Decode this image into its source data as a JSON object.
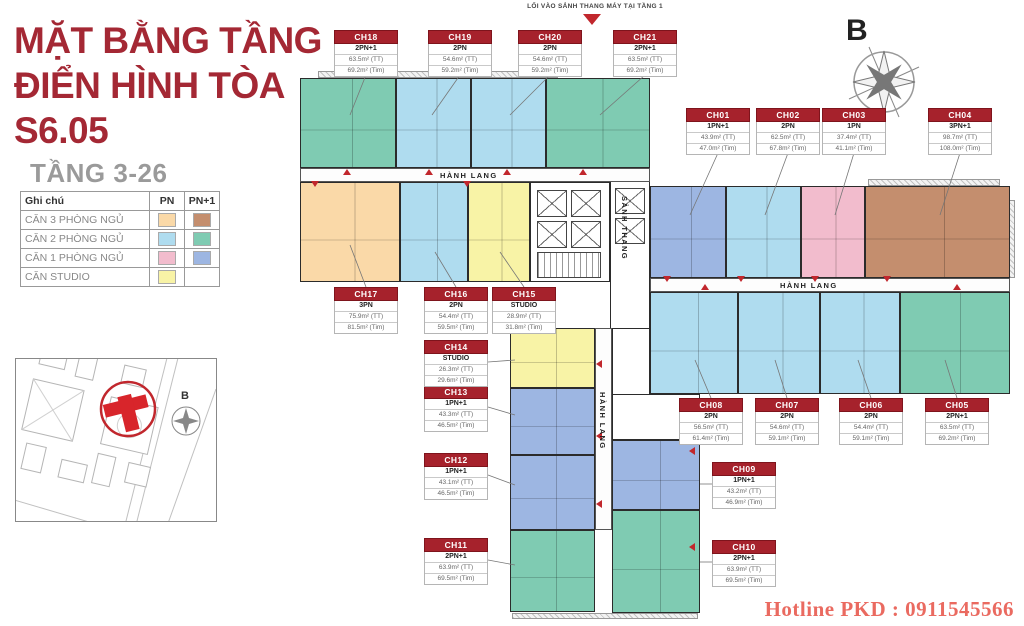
{
  "header": {
    "title_line1": "MẶT BẰNG TẦNG",
    "title_line2": "ĐIỂN HÌNH TÒA",
    "title_line3": "S6.05",
    "subtitle": "TẦNG 3-26"
  },
  "entrance_note": "LỐI VÀO SẢNH THANG MÁY TẠI TẦNG 1",
  "compass": {
    "label": "B"
  },
  "inset": {
    "compass_label": "B"
  },
  "hotline": "Hotline PKD : 0911545566",
  "corridors": {
    "hallway": "HÀNH LANG",
    "lobby": "SẢNH THANG"
  },
  "colors": {
    "accent": "#A42834",
    "marker_red": "#C1272D",
    "hotline_red": "#EA6A60",
    "cat": {
      "pn3": "#FAD9A8",
      "pn3p": "#C48E6E",
      "pn2": "#AFDCEF",
      "pn2p": "#7FCBB2",
      "pn1": "#F2BCCD",
      "pn1p": "#9DB6E2",
      "studio": "#F8F3A6"
    }
  },
  "legend": {
    "col_label": "Ghi chú",
    "col_pn": "PN",
    "col_pn1": "PN+1",
    "rows": [
      {
        "label": "CĂN 3 PHÒNG NGỦ",
        "pn": "pn3",
        "pn1": "pn3p"
      },
      {
        "label": "CĂN 2 PHÒNG NGỦ",
        "pn": "pn2",
        "pn1": "pn2p"
      },
      {
        "label": "CĂN 1 PHÒNG NGỦ",
        "pn": "pn1",
        "pn1": "pn1p"
      },
      {
        "label": "CĂN STUDIO",
        "pn": "studio",
        "pn1": null
      }
    ]
  },
  "units": [
    {
      "code": "CH01",
      "type": "1PN+1",
      "area_tt": "43.9m² (TT)",
      "area_tim": "47.0m² (Tim)",
      "cat": "pn1p"
    },
    {
      "code": "CH02",
      "type": "2PN",
      "area_tt": "62.5m² (TT)",
      "area_tim": "67.8m² (Tim)",
      "cat": "pn2"
    },
    {
      "code": "CH03",
      "type": "1PN",
      "area_tt": "37.4m² (TT)",
      "area_tim": "41.1m² (Tim)",
      "cat": "pn1"
    },
    {
      "code": "CH04",
      "type": "3PN+1",
      "area_tt": "98.7m² (TT)",
      "area_tim": "108.0m² (Tim)",
      "cat": "pn3p"
    },
    {
      "code": "CH05",
      "type": "2PN+1",
      "area_tt": "63.5m² (TT)",
      "area_tim": "69.2m² (Tim)",
      "cat": "pn2p"
    },
    {
      "code": "CH06",
      "type": "2PN",
      "area_tt": "54.4m² (TT)",
      "area_tim": "59.1m² (Tim)",
      "cat": "pn2"
    },
    {
      "code": "CH07",
      "type": "2PN",
      "area_tt": "54.6m² (TT)",
      "area_tim": "59.1m² (Tim)",
      "cat": "pn2"
    },
    {
      "code": "CH08",
      "type": "2PN",
      "area_tt": "56.5m² (TT)",
      "area_tim": "61.4m² (Tim)",
      "cat": "pn2"
    },
    {
      "code": "CH09",
      "type": "1PN+1",
      "area_tt": "43.2m² (TT)",
      "area_tim": "46.9m² (Tim)",
      "cat": "pn1p"
    },
    {
      "code": "CH10",
      "type": "2PN+1",
      "area_tt": "63.9m² (TT)",
      "area_tim": "69.5m² (Tim)",
      "cat": "pn2p"
    },
    {
      "code": "CH11",
      "type": "2PN+1",
      "area_tt": "63.9m² (TT)",
      "area_tim": "69.5m² (Tim)",
      "cat": "pn2p"
    },
    {
      "code": "CH12",
      "type": "1PN+1",
      "area_tt": "43.1m² (TT)",
      "area_tim": "46.5m² (Tim)",
      "cat": "pn1p"
    },
    {
      "code": "CH13",
      "type": "1PN+1",
      "area_tt": "43.3m² (TT)",
      "area_tim": "46.5m² (Tim)",
      "cat": "pn1p"
    },
    {
      "code": "CH14",
      "type": "STUDIO",
      "area_tt": "26.3m² (TT)",
      "area_tim": "29.6m² (Tim)",
      "cat": "studio"
    },
    {
      "code": "CH15",
      "type": "STUDIO",
      "area_tt": "28.9m² (TT)",
      "area_tim": "31.8m² (Tim)",
      "cat": "studio"
    },
    {
      "code": "CH16",
      "type": "2PN",
      "area_tt": "54.4m² (TT)",
      "area_tim": "59.5m² (Tim)",
      "cat": "pn2"
    },
    {
      "code": "CH17",
      "type": "3PN",
      "area_tt": "75.9m² (TT)",
      "area_tim": "81.5m² (Tim)",
      "cat": "pn3"
    },
    {
      "code": "CH18",
      "type": "2PN+1",
      "area_tt": "63.5m² (TT)",
      "area_tim": "69.2m² (Tim)",
      "cat": "pn2p"
    },
    {
      "code": "CH19",
      "type": "2PN",
      "area_tt": "54.6m² (TT)",
      "area_tim": "59.2m² (Tim)",
      "cat": "pn2"
    },
    {
      "code": "CH20",
      "type": "2PN",
      "area_tt": "54.6m² (TT)",
      "area_tim": "59.2m² (Tim)",
      "cat": "pn2"
    },
    {
      "code": "CH21",
      "type": "2PN+1",
      "area_tt": "63.5m² (TT)",
      "area_tim": "69.2m² (Tim)",
      "cat": "pn2p"
    }
  ]
}
